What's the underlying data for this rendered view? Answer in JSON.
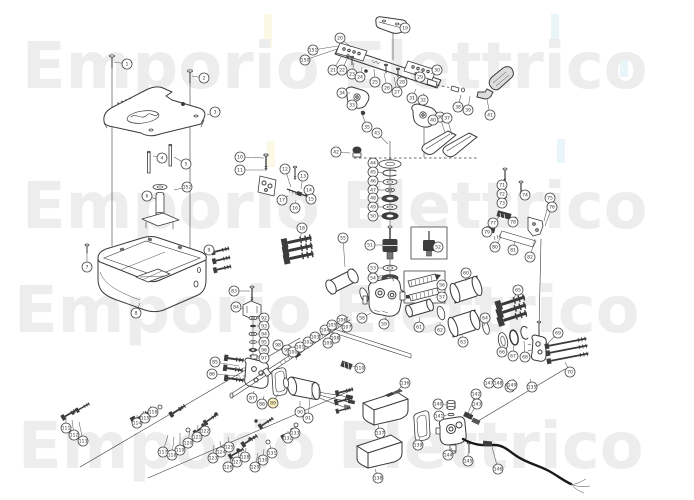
{
  "watermark": {
    "text": "Emporio Elettrico",
    "color": "#ededed",
    "font_size": 64,
    "rows": [
      {
        "x": 22,
        "y": 88
      },
      {
        "x": 22,
        "y": 228
      },
      {
        "x": 14,
        "y": 332
      },
      {
        "x": 18,
        "y": 468
      }
    ]
  },
  "highlights": [
    {
      "x": 264,
      "y": 14,
      "w": 8,
      "h": 34,
      "color": "#fcf8e6"
    },
    {
      "x": 267,
      "y": 141,
      "w": 8,
      "h": 26,
      "color": "#fcf8e6"
    },
    {
      "x": 551,
      "y": 14,
      "w": 8,
      "h": 30,
      "color": "#e9f5f9"
    },
    {
      "x": 557,
      "y": 139,
      "w": 8,
      "h": 24,
      "color": "#e9f5f9"
    },
    {
      "x": 620,
      "y": 57,
      "w": 8,
      "h": 20,
      "color": "#e9f5f9"
    }
  ],
  "callouts": {
    "radius": 5,
    "stroke": "#474747",
    "fill": "#ffffff",
    "highlight_fill": "#faf0bc",
    "number_color": "#333333",
    "font_size": 4.6,
    "format": "[label, cx, cy, leader_x, leader_y, highlighted]",
    "items": [
      [
        1,
        127,
        64,
        114,
        62
      ],
      [
        2,
        204,
        78,
        192,
        76
      ],
      [
        3,
        215,
        112,
        207,
        115
      ],
      [
        4,
        162,
        158,
        153,
        156
      ],
      [
        5,
        186,
        164,
        174,
        157
      ],
      [
        6,
        147,
        196,
        156,
        199
      ],
      [
        7,
        87,
        267,
        87,
        253
      ],
      [
        8,
        136,
        313,
        140,
        303
      ],
      [
        9,
        209,
        250,
        215,
        252
      ],
      [
        10,
        240,
        157,
        264,
        158
      ],
      [
        11,
        240,
        170,
        265,
        170
      ],
      [
        12,
        285,
        169,
        291,
        187
      ],
      [
        13,
        303,
        176,
        301,
        189
      ],
      [
        14,
        309,
        190,
        305,
        193
      ],
      [
        15,
        311,
        199,
        306,
        197
      ],
      [
        16,
        295,
        208,
        296,
        200
      ],
      [
        17,
        282,
        200,
        288,
        196
      ],
      [
        18,
        302,
        228,
        300,
        241
      ],
      [
        19,
        405,
        28,
        398,
        23
      ],
      [
        20,
        340,
        38,
        351,
        47
      ],
      [
        21,
        333,
        70,
        341,
        57
      ],
      [
        22,
        342,
        70,
        347,
        59
      ],
      [
        23,
        352,
        74,
        354,
        63
      ],
      [
        24,
        360,
        77,
        362,
        67
      ],
      [
        25,
        375,
        82,
        374,
        69
      ],
      [
        26,
        387,
        88,
        384,
        73
      ],
      [
        27,
        397,
        92,
        394,
        77
      ],
      [
        28,
        402,
        82,
        400,
        75
      ],
      [
        29,
        420,
        77,
        418,
        71
      ],
      [
        30,
        437,
        70,
        431,
        74
      ],
      [
        31,
        412,
        98,
        416,
        89
      ],
      [
        32,
        423,
        100,
        424,
        93
      ],
      [
        33,
        352,
        105,
        360,
        99
      ],
      [
        34,
        342,
        93,
        350,
        93
      ],
      [
        35,
        367,
        127,
        361,
        111
      ],
      [
        36,
        440,
        117,
        445,
        133
      ],
      [
        37,
        447,
        118,
        452,
        135
      ],
      [
        38,
        458,
        107,
        461,
        95
      ],
      [
        39,
        468,
        110,
        470,
        96
      ],
      [
        40,
        433,
        120,
        429,
        122
      ],
      [
        41,
        490,
        115,
        487,
        99
      ],
      [
        42,
        336,
        152,
        350,
        153
      ],
      [
        43,
        377,
        133,
        388,
        144
      ],
      [
        44,
        373,
        163,
        380,
        163
      ],
      [
        45,
        373,
        172,
        383,
        173
      ],
      [
        46,
        373,
        181,
        384,
        182
      ],
      [
        47,
        373,
        190,
        386,
        190
      ],
      [
        48,
        373,
        198,
        383,
        198
      ],
      [
        49,
        373,
        207,
        384,
        207
      ],
      [
        50,
        373,
        216,
        383,
        216
      ],
      [
        51,
        370,
        245,
        382,
        245
      ],
      [
        52,
        438,
        247,
        null,
        null
      ],
      [
        53,
        373,
        268,
        384,
        268
      ],
      [
        54,
        373,
        278,
        383,
        278
      ],
      [
        55,
        343,
        238,
        345,
        267
      ],
      [
        56,
        442,
        285,
        null,
        null
      ],
      [
        57,
        442,
        297,
        null,
        null
      ],
      [
        58,
        362,
        318,
        371,
        313
      ],
      [
        59,
        384,
        324,
        386,
        317
      ],
      [
        60,
        466,
        273,
        466,
        281
      ],
      [
        61,
        419,
        327,
        420,
        317
      ],
      [
        62,
        440,
        330,
        440,
        322
      ],
      [
        63,
        463,
        342,
        462,
        335
      ],
      [
        64,
        485,
        318,
        484,
        326
      ],
      [
        65,
        518,
        290,
        513,
        300
      ],
      [
        66,
        502,
        352,
        503,
        347
      ],
      [
        67,
        513,
        356,
        514,
        344
      ],
      [
        68,
        525,
        357,
        524,
        341
      ],
      [
        69,
        558,
        333,
        548,
        343
      ],
      [
        70,
        570,
        372,
        565,
        362
      ],
      [
        71,
        502,
        185,
        505,
        177
      ],
      [
        72,
        502,
        194,
        506,
        187
      ],
      [
        73,
        502,
        203,
        507,
        197
      ],
      [
        74,
        525,
        195,
        521,
        190
      ],
      [
        75,
        550,
        198,
        544,
        221
      ],
      [
        76,
        552,
        207,
        545,
        226
      ],
      [
        77,
        493,
        223,
        499,
        217
      ],
      [
        78,
        513,
        222,
        513,
        219
      ],
      [
        79,
        487,
        232,
        491,
        229
      ],
      [
        80,
        495,
        247,
        501,
        237
      ],
      [
        81,
        513,
        250,
        515,
        241
      ],
      [
        82,
        530,
        257,
        535,
        239
      ],
      [
        83,
        234,
        291,
        250,
        291
      ],
      [
        84,
        236,
        307,
        244,
        309
      ],
      [
        85,
        215,
        362,
        239,
        366
      ],
      [
        86,
        212,
        374,
        240,
        376
      ],
      [
        87,
        252,
        398,
        254,
        391
      ],
      [
        88,
        262,
        404,
        264,
        396
      ],
      [
        89,
        273,
        403,
        278,
        394,
        1
      ],
      [
        90,
        300,
        412,
        300,
        401
      ],
      [
        91,
        308,
        418,
        310,
        399
      ],
      [
        92,
        264,
        318,
        257,
        318
      ],
      [
        93,
        264,
        326,
        257,
        326
      ],
      [
        94,
        264,
        334,
        257,
        334
      ],
      [
        95,
        264,
        342,
        257,
        342
      ],
      [
        96,
        264,
        350,
        257,
        350
      ],
      [
        97,
        264,
        358,
        257,
        356
      ],
      [
        98,
        278,
        345,
        286,
        356
      ],
      [
        99,
        287,
        350,
        292,
        358
      ],
      [
        100,
        293,
        352,
        297,
        360
      ],
      [
        101,
        300,
        347,
        302,
        353
      ],
      [
        102,
        308,
        342,
        308,
        349
      ],
      [
        103,
        315,
        337,
        314,
        343
      ],
      [
        104,
        325,
        330,
        322,
        337
      ],
      [
        105,
        332,
        325,
        330,
        332
      ],
      [
        106,
        342,
        320,
        338,
        327
      ],
      [
        107,
        347,
        327,
        342,
        332
      ],
      [
        108,
        335,
        338,
        332,
        342
      ],
      [
        109,
        328,
        343,
        326,
        347
      ],
      [
        110,
        360,
        368,
        352,
        366
      ],
      [
        111,
        66,
        428,
        66,
        417
      ],
      [
        112,
        74,
        435,
        72,
        420
      ],
      [
        113,
        83,
        441,
        79,
        422
      ],
      [
        114,
        137,
        423,
        137,
        415
      ],
      [
        115,
        145,
        418,
        143,
        411
      ],
      [
        116,
        153,
        412,
        150,
        406
      ],
      [
        117,
        163,
        452,
        168,
        435
      ],
      [
        118,
        172,
        455,
        174,
        437
      ],
      [
        119,
        180,
        450,
        180,
        433
      ],
      [
        120,
        188,
        443,
        190,
        429
      ],
      [
        121,
        197,
        437,
        198,
        425
      ],
      [
        122,
        205,
        431,
        204,
        421
      ],
      [
        123,
        213,
        458,
        214,
        445
      ],
      [
        124,
        221,
        452,
        220,
        441
      ],
      [
        125,
        229,
        447,
        228,
        437
      ],
      [
        126,
        228,
        467,
        232,
        457
      ],
      [
        127,
        237,
        462,
        239,
        453
      ],
      [
        128,
        245,
        457,
        246,
        448
      ],
      [
        129,
        255,
        467,
        258,
        453
      ],
      [
        130,
        263,
        460,
        264,
        449
      ],
      [
        131,
        272,
        453,
        270,
        445
      ],
      [
        132,
        288,
        438,
        288,
        431
      ],
      [
        133,
        295,
        433,
        294,
        427
      ],
      [
        134,
        510,
        387,
        514,
        379
      ],
      [
        135,
        532,
        387,
        530,
        379
      ],
      [
        136,
        405,
        383,
        397,
        391
      ],
      [
        137,
        380,
        433,
        378,
        425
      ],
      [
        138,
        378,
        478,
        375,
        469
      ],
      [
        139,
        418,
        445,
        420,
        437
      ],
      [
        140,
        438,
        404,
        446,
        405
      ],
      [
        141,
        439,
        416,
        447,
        415
      ],
      [
        142,
        476,
        394,
        468,
        413
      ],
      [
        143,
        477,
        404,
        469,
        417
      ],
      [
        144,
        448,
        455,
        452,
        448
      ],
      [
        145,
        468,
        461,
        468,
        453
      ],
      [
        146,
        498,
        469,
        492,
        447
      ],
      [
        147,
        489,
        383,
        null,
        null
      ],
      [
        148,
        498,
        383,
        null,
        null
      ],
      [
        149,
        512,
        385,
        null,
        null
      ],
      [
        150,
        305,
        60,
        337,
        49
      ],
      [
        151,
        313,
        50,
        338,
        46
      ],
      [
        152,
        187,
        187,
        174,
        190
      ]
    ]
  }
}
